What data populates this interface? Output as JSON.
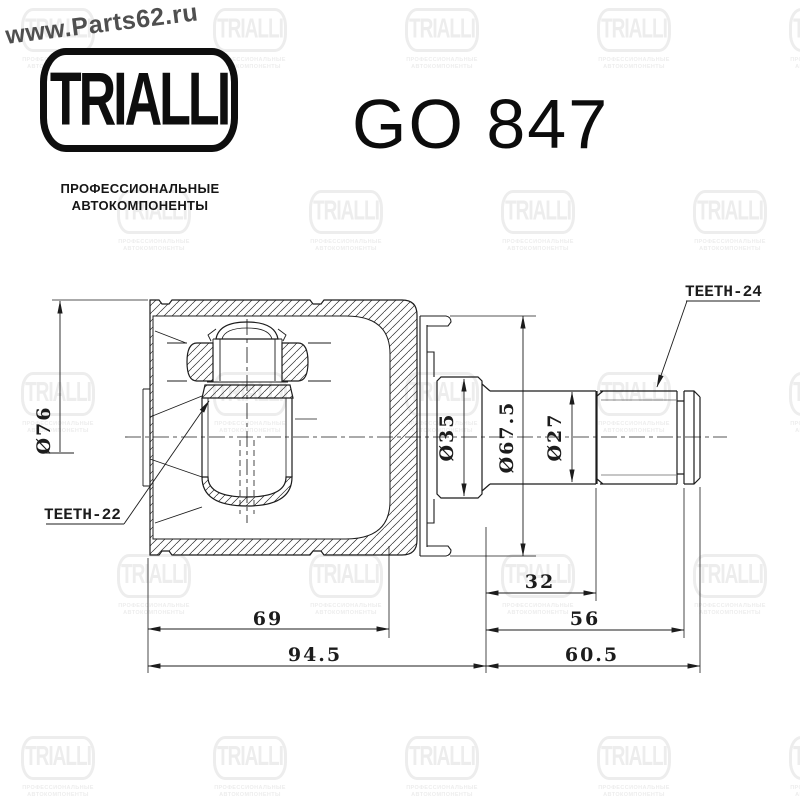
{
  "header": {
    "site": "www.Parts62.ru",
    "brand": "TRIALLI",
    "subtitle_line1": "ПРОФЕССИОНАЛЬНЫЕ",
    "subtitle_line2": "АВТОКОМПОНЕНТЫ",
    "part_number": "GO 847"
  },
  "drawing": {
    "dimensions": {
      "outer_diameter": "Ø76",
      "hub_diameter": "Ø35",
      "flange_diameter": "Ø67.5",
      "shaft_diameter": "Ø27",
      "teeth_left": "TEETH-22",
      "teeth_right": "TEETH-24",
      "len_32": "32",
      "len_56": "56",
      "len_69": "69",
      "len_94_5": "94.5",
      "len_60_5": "60.5"
    }
  },
  "watermark": {
    "logo_text": "TRIALLI",
    "subtitle_line1": "ПРОФЕССИОНАЛЬНЫЕ",
    "subtitle_line2": "АВТОКОМПОНЕНТЫ",
    "color": "#ededed"
  },
  "colors": {
    "line": "#1c1c1c",
    "background": "#ffffff",
    "site_text": "#4f4f4f"
  }
}
